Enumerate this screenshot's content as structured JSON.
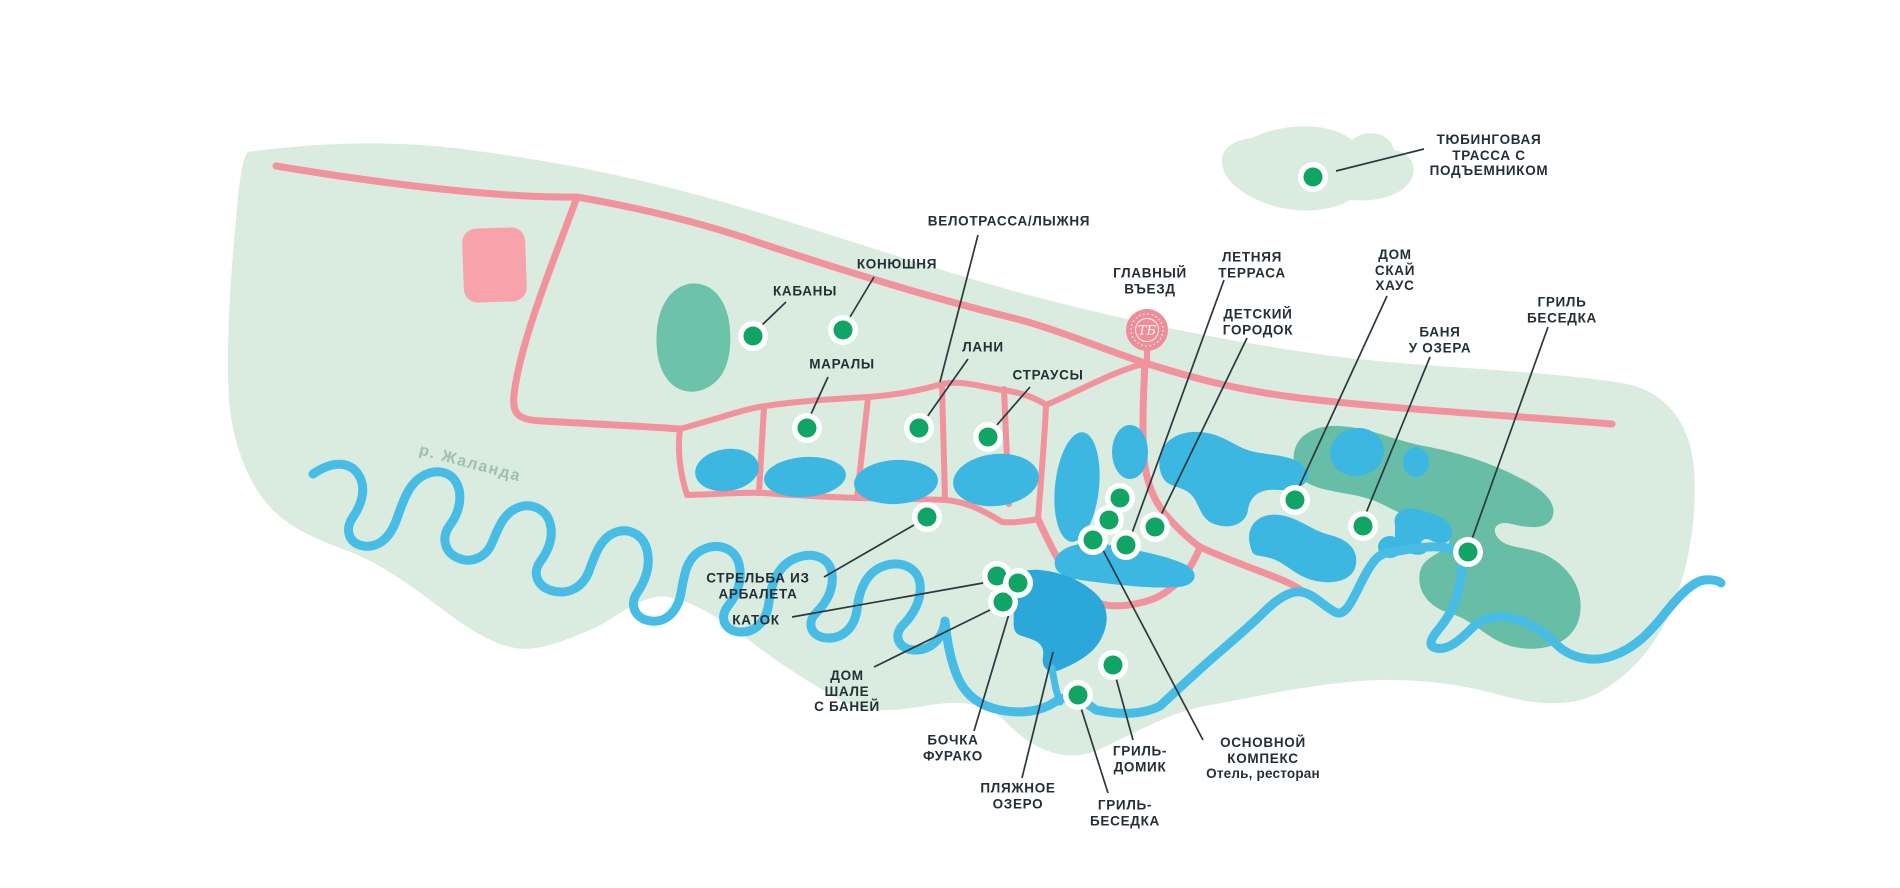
{
  "map": {
    "background_color": "#ffffff",
    "territory_color": "#d9ecdf",
    "forest_color": "#6cc2aa",
    "forest_dark_color": "#67bda6",
    "lake_color": "#3cb7e2",
    "beach_lake_color": "#2ba7d9",
    "river_color": "#47bde5",
    "road_color": "#f2929d",
    "building_color": "#f8a3ab",
    "marker_color": "#10a465",
    "label_color": "#242f36",
    "leader_color": "#2c3840",
    "river_label_color": "#9fbfad",
    "logo_color": "#ef8e98",
    "river_label": {
      "text": "р. Жаланда",
      "x": 470,
      "y": 464,
      "rotation_deg": 15
    },
    "entrance_logo": {
      "monogram": "ТБ",
      "x": 1147,
      "y": 330
    },
    "pois": [
      {
        "id": "tubing-track",
        "lines": [
          "ТЮБИНГОВАЯ",
          "ТРАССА С",
          "ПОДЪЕМНИКОМ"
        ],
        "subtitle": null,
        "label_x": 1489,
        "label_y": 155,
        "marker": {
          "x": 1313,
          "y": 177
        },
        "leader": [
          1424,
          149,
          1336,
          171
        ]
      },
      {
        "id": "velotrassa-lyzhnya",
        "lines": [
          "ВЕЛОТРАССА/ЛЫЖНЯ"
        ],
        "subtitle": null,
        "label_x": 1009,
        "label_y": 221,
        "marker": null,
        "leader": [
          978,
          235,
          940,
          382
        ]
      },
      {
        "id": "konyushnya",
        "lines": [
          "КОНЮШНЯ"
        ],
        "subtitle": null,
        "label_x": 897,
        "label_y": 264,
        "marker": {
          "x": 843,
          "y": 330
        },
        "leader": [
          874,
          277,
          850,
          317
        ]
      },
      {
        "id": "kabany",
        "lines": [
          "КАБАНЫ"
        ],
        "subtitle": null,
        "label_x": 805,
        "label_y": 291,
        "marker": {
          "x": 753,
          "y": 336
        },
        "leader": [
          786,
          302,
          761,
          326
        ]
      },
      {
        "id": "maraly",
        "lines": [
          "МАРАЛЫ"
        ],
        "subtitle": null,
        "label_x": 842,
        "label_y": 364,
        "marker": {
          "x": 807,
          "y": 428
        },
        "leader": [
          828,
          377,
          811,
          414
        ]
      },
      {
        "id": "lani",
        "lines": [
          "ЛАНИ"
        ],
        "subtitle": null,
        "label_x": 983,
        "label_y": 347,
        "marker": {
          "x": 919,
          "y": 428
        },
        "leader": [
          968,
          359,
          927,
          417
        ]
      },
      {
        "id": "strausy",
        "lines": [
          "СТРАУСЫ"
        ],
        "subtitle": null,
        "label_x": 1048,
        "label_y": 375,
        "marker": {
          "x": 988,
          "y": 437
        },
        "leader": [
          1030,
          387,
          996,
          426
        ]
      },
      {
        "id": "glavny-vezd",
        "lines": [
          "ГЛАВНЫЙ",
          "ВЪЕЗД"
        ],
        "subtitle": null,
        "label_x": 1150,
        "label_y": 281,
        "marker": null,
        "leader": null
      },
      {
        "id": "letnyaya-terrasa",
        "lines": [
          "ЛЕТНЯЯ",
          "ТЕРРАСА"
        ],
        "subtitle": null,
        "label_x": 1252,
        "label_y": 265,
        "marker": {
          "x": 1126,
          "y": 545
        },
        "leader": [
          1224,
          280,
          1132,
          533
        ]
      },
      {
        "id": "detsky-gorodok",
        "lines": [
          "ДЕТСКИЙ",
          "ГОРОДОК"
        ],
        "subtitle": null,
        "label_x": 1258,
        "label_y": 322,
        "marker": {
          "x": 1155,
          "y": 527
        },
        "leader": [
          1247,
          338,
          1161,
          515
        ]
      },
      {
        "id": "dom-skay-haus",
        "lines": [
          "ДОМ",
          "СКАЙ",
          "ХАУС"
        ],
        "subtitle": null,
        "label_x": 1395,
        "label_y": 270,
        "marker": {
          "x": 1295,
          "y": 500
        },
        "leader": [
          1387,
          296,
          1299,
          487
        ]
      },
      {
        "id": "banya-u-ozera",
        "lines": [
          "БАНЯ",
          "У ОЗЕРА"
        ],
        "subtitle": null,
        "label_x": 1440,
        "label_y": 340,
        "marker": {
          "x": 1363,
          "y": 526
        },
        "leader": [
          1430,
          357,
          1366,
          513
        ]
      },
      {
        "id": "gril-besedka-east",
        "lines": [
          "ГРИЛЬ",
          "БЕСЕДКА"
        ],
        "subtitle": null,
        "label_x": 1562,
        "label_y": 310,
        "marker": {
          "x": 1468,
          "y": 552
        },
        "leader": [
          1548,
          327,
          1472,
          539
        ]
      },
      {
        "id": "strelba-iz-arbaleta",
        "lines": [
          "СТРЕЛЬБА ИЗ",
          "АРБАЛЕТА"
        ],
        "subtitle": null,
        "label_x": 758,
        "label_y": 586,
        "marker": {
          "x": 927,
          "y": 517
        },
        "leader": [
          824,
          577,
          914,
          525
        ]
      },
      {
        "id": "katok",
        "lines": [
          "КАТОК"
        ],
        "subtitle": null,
        "label_x": 756,
        "label_y": 620,
        "marker": {
          "x": 997,
          "y": 576
        },
        "leader": [
          792,
          617,
          983,
          583
        ]
      },
      {
        "id": "dom-shale-s-baney",
        "lines": [
          "ДОМ",
          "ШАЛЕ",
          "С БАНЕЙ"
        ],
        "subtitle": null,
        "label_x": 847,
        "label_y": 691,
        "marker": {
          "x": 1003,
          "y": 602
        },
        "leader": [
          874,
          667,
          990,
          610
        ]
      },
      {
        "id": "bochka-furako",
        "lines": [
          "БОЧКА",
          "ФУРАКО"
        ],
        "subtitle": null,
        "label_x": 953,
        "label_y": 748,
        "marker": {
          "x": 1018,
          "y": 583
        },
        "leader": [
          974,
          731,
          1014,
          597
        ]
      },
      {
        "id": "plyazhnoe-ozero",
        "lines": [
          "ПЛЯЖНОЕ",
          "ОЗЕРО"
        ],
        "subtitle": null,
        "label_x": 1018,
        "label_y": 796,
        "marker": null,
        "leader": [
          1022,
          778,
          1053,
          652
        ]
      },
      {
        "id": "gril-domik",
        "lines": [
          "ГРИЛЬ-",
          "ДОМИК"
        ],
        "subtitle": null,
        "label_x": 1140,
        "label_y": 759,
        "marker": {
          "x": 1113,
          "y": 665
        },
        "leader": [
          1133,
          740,
          1116,
          678
        ]
      },
      {
        "id": "gril-besedka-south",
        "lines": [
          "ГРИЛЬ-",
          "БЕСЕДКА"
        ],
        "subtitle": null,
        "label_x": 1125,
        "label_y": 813,
        "marker": {
          "x": 1078,
          "y": 695
        },
        "leader": [
          1108,
          793,
          1081,
          708
        ]
      },
      {
        "id": "osnovnoy-kompeks",
        "lines": [
          "ОСНОВНОЙ",
          "КОМПЕКС"
        ],
        "subtitle": "Отель, ресторан",
        "label_x": 1263,
        "label_y": 758,
        "marker": {
          "x": 1093,
          "y": 540
        },
        "leader": [
          1203,
          740,
          1103,
          550
        ]
      },
      {
        "id": "complex-building-1",
        "lines": null,
        "subtitle": null,
        "label_x": null,
        "label_y": null,
        "marker": {
          "x": 1120,
          "y": 498
        },
        "leader": null
      },
      {
        "id": "complex-building-2",
        "lines": null,
        "subtitle": null,
        "label_x": null,
        "label_y": null,
        "marker": {
          "x": 1109,
          "y": 520
        },
        "leader": null
      }
    ]
  }
}
